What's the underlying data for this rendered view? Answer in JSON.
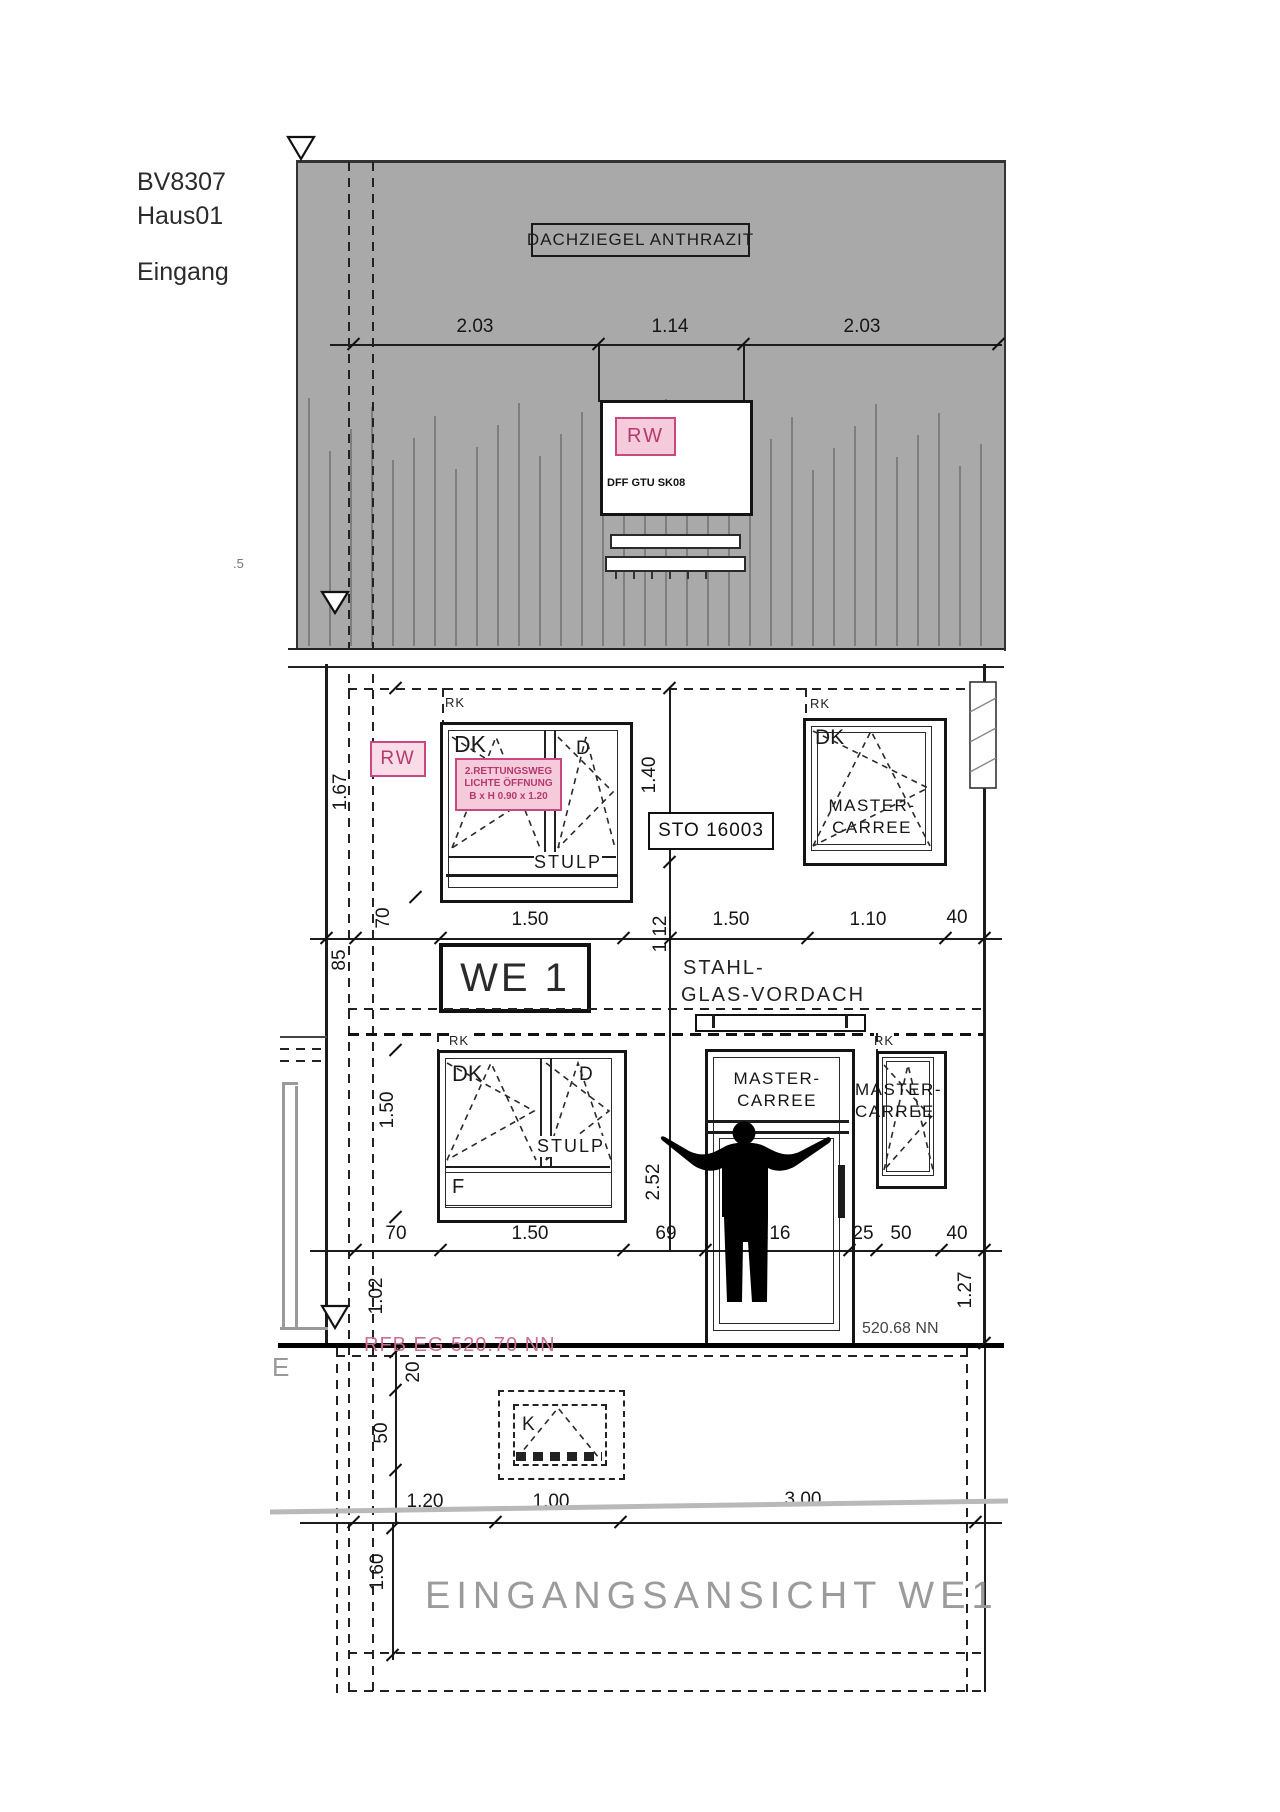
{
  "header": {
    "project": "BV8307",
    "house": "Haus01",
    "view": "Eingang"
  },
  "roof": {
    "material_label": "DACHZIEGEL ANTHRAZIT",
    "rw_label": "RW",
    "window_type": "DFF GTU SK08"
  },
  "window_labels": {
    "rk": "RK",
    "dk": "DK",
    "d": "D",
    "stulp": "STULP",
    "f": "F",
    "k": "K",
    "master_line1": "MASTER-",
    "master_line2": "CARREE"
  },
  "rescue_box": {
    "line1": "2.RETTUNGSWEG",
    "line2": "LICHTE ÖFFNUNG",
    "line3": "B x H  0.90 x 1.20"
  },
  "annotations": {
    "rw_wall": "RW",
    "sto": "STO 16003",
    "we": "WE 1",
    "canopy_line1": "STAHL-",
    "canopy_line2": "GLAS-VORDACH",
    "level_left": "RFB EG 520.70 NN",
    "level_right": "520.68 NN",
    "cut_left": ".5",
    "cut_e": "E",
    "title": "EINGANGSANSICHT WE1"
  },
  "dimensions": {
    "roof": {
      "d1": "2.03",
      "d2": "1.14",
      "d3": "2.03"
    },
    "row1": {
      "d1": "70",
      "d2": "1.50",
      "d3": "1.12",
      "d4": "1.50",
      "d5": "1.10",
      "d6": "40"
    },
    "left1": {
      "h85": "85",
      "h167": "1.67"
    },
    "v140": "1.40",
    "row2": {
      "d1": "70",
      "d2": "1.50",
      "d3": "69",
      "d4": "1.16",
      "d5": "25",
      "d6": "50",
      "d7": "40"
    },
    "v150": "1.50",
    "v252": "2.52",
    "v102": "1.02",
    "v127": "1.27",
    "v20": "20",
    "v50": "50",
    "v160": "1.60",
    "row3": {
      "d1": "1.20",
      "d2": "1.00",
      "d3": "3.00"
    }
  },
  "colors": {
    "accent_pink": "#c8497f",
    "pink_fill": "#f5cadb",
    "pink_text": "#b43a6e",
    "roof_gray": "#a9a9a9",
    "batten_gray": "#7e7e7e",
    "title_gray": "#9b9b9b",
    "level_pink": "#cc6e92"
  }
}
